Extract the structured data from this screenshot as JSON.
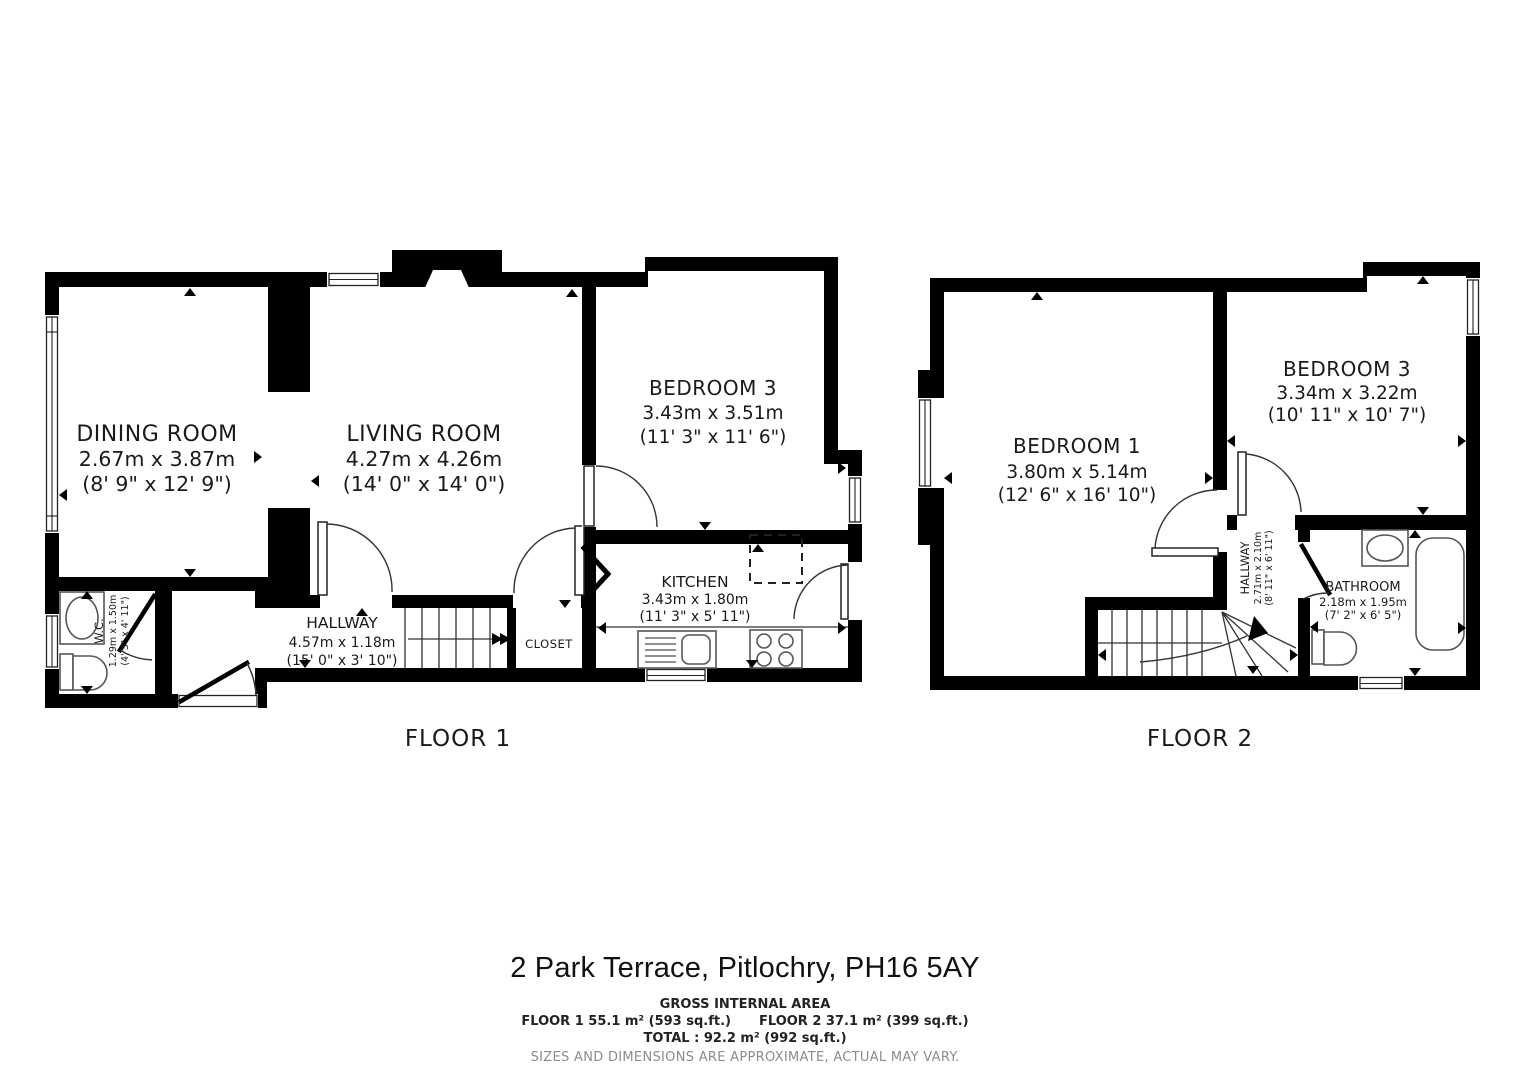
{
  "title": "2 Park Terrace, Pitlochry, PH16 5AY",
  "footer": {
    "gross_heading": "GROSS INTERNAL AREA",
    "floor1_area": "FLOOR 1 55.1 m² (593 sq.ft.)",
    "floor2_area": "FLOOR 2 37.1 m² (399 sq.ft.)",
    "total": "TOTAL :  92.2 m² (992 sq.ft.)",
    "disclaimer": "SIZES AND DIMENSIONS ARE APPROXIMATE, ACTUAL MAY VARY."
  },
  "floor1": {
    "label": "FLOOR 1",
    "rooms": {
      "dining": {
        "name": "DINING ROOM",
        "metric": "2.67m x 3.87m",
        "imperial": "(8' 9\" x 12' 9\")"
      },
      "living": {
        "name": "LIVING ROOM",
        "metric": "4.27m x 4.26m",
        "imperial": "(14' 0\" x 14' 0\")"
      },
      "bedroom3": {
        "name": "BEDROOM 3",
        "metric": "3.43m x 3.51m",
        "imperial": "(11' 3\" x 11' 6\")"
      },
      "kitchen": {
        "name": "KITCHEN",
        "metric": "3.43m x 1.80m",
        "imperial": "(11' 3\" x 5' 11\")"
      },
      "hallway": {
        "name": "HALLWAY",
        "metric": "4.57m x 1.18m",
        "imperial": "(15' 0\" x 3' 10\")"
      },
      "wc": {
        "name": "W.C.",
        "metric": "1.29m x 1.50m",
        "imperial": "(4' 3\" x 4' 11\")"
      },
      "closet": {
        "name": "CLOSET"
      }
    }
  },
  "floor2": {
    "label": "FLOOR 2",
    "rooms": {
      "bedroom1": {
        "name": "BEDROOM 1",
        "metric": "3.80m x 5.14m",
        "imperial": "(12' 6\" x 16' 10\")"
      },
      "bedroom3": {
        "name": "BEDROOM 3",
        "metric": "3.34m x 3.22m",
        "imperial": "(10' 11\" x 10' 7\")"
      },
      "hallway": {
        "name": "HALLWAY",
        "metric": "2.71m x 2.10m",
        "imperial": "(8' 11\" x 6' 11\")"
      },
      "bathroom": {
        "name": "BATHROOM",
        "metric": "2.18m x 1.95m",
        "imperial": "(7' 2\" x 6' 5\")"
      }
    }
  }
}
